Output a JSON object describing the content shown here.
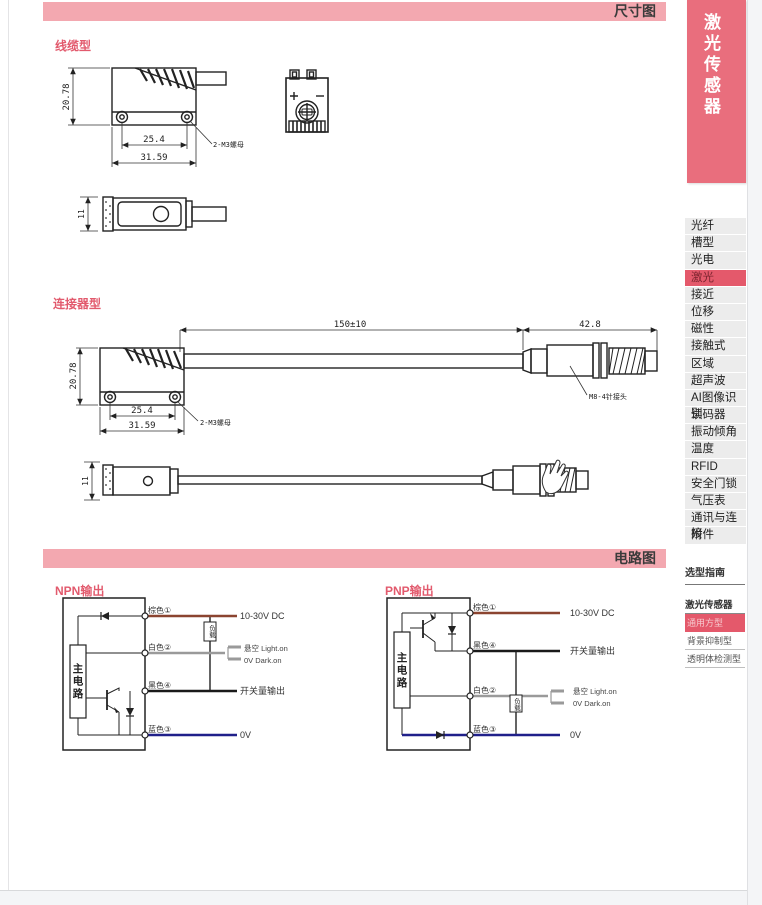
{
  "page": {
    "dimension_section_title": "尺寸图",
    "circuit_section_title": "电路图"
  },
  "dimensions": {
    "cable_type": {
      "label": "线缆型",
      "height": "20.78",
      "hole_pitch": "25.4",
      "body_width": "31.59",
      "screw_note": "2-M3螺母",
      "thickness": "11",
      "polarity_plus": "+",
      "polarity_minus": "-"
    },
    "connector_type": {
      "label": "连接器型",
      "cable_length": "150±10",
      "connector_length": "42.8",
      "height": "20.78",
      "hole_pitch": "25.4",
      "body_width": "31.59",
      "screw_note": "2-M3螺母",
      "connector_note": "M8-4针接头",
      "thickness": "11"
    }
  },
  "circuits": {
    "npn": {
      "title": "NPN输出",
      "main_circuit": "主电路",
      "load": "负载",
      "wire1_name": "棕色①",
      "wire1_target": "10-30V DC",
      "wire2_name": "白色②",
      "wire2_target_line1": "悬空 Light.on",
      "wire2_target_line2": "0V Dark.on",
      "wire3_name": "黑色④",
      "wire3_target": "开关量输出",
      "wire4_name": "蓝色③",
      "wire4_target": "0V"
    },
    "pnp": {
      "title": "PNP输出",
      "main_circuit": "主电路",
      "load": "负载",
      "wire1_name": "棕色①",
      "wire1_target": "10-30V DC",
      "wire2_name": "黑色④",
      "wire2_target": "开关量输出",
      "wire3_name": "白色②",
      "wire3_target_line1": "悬空 Light.on",
      "wire3_target_line2": "0V Dark.on",
      "wire4_name": "蓝色③",
      "wire4_target": "0V"
    }
  },
  "sidebar": {
    "tab_title": "激光传感器",
    "menu": [
      "光纤",
      "槽型",
      "光电",
      "激光",
      "接近",
      "位移",
      "磁性",
      "接触式",
      "区域",
      "超声波",
      "AI图像识别",
      "读码器",
      "振动倾角",
      "温度",
      "RFID",
      "安全门锁",
      "气压表",
      "通讯与连接",
      "附件"
    ],
    "active_menu_item": "激光",
    "guide_title": "选型指南",
    "series_title": "激光传感器",
    "series_items": [
      "通用方型",
      "背景抑制型",
      "透明体检测型"
    ],
    "active_series_item": "通用方型"
  },
  "colors": {
    "header_bar": "#f3a8b0",
    "accent": "#e25a6d",
    "sidebar_tab": "#e96e7d",
    "active_row": "#e4596b",
    "wire_brown": "#8b4430",
    "wire_gray": "#9a9a9a",
    "wire_black": "#1a1a1a",
    "wire_blue": "#20208a"
  }
}
